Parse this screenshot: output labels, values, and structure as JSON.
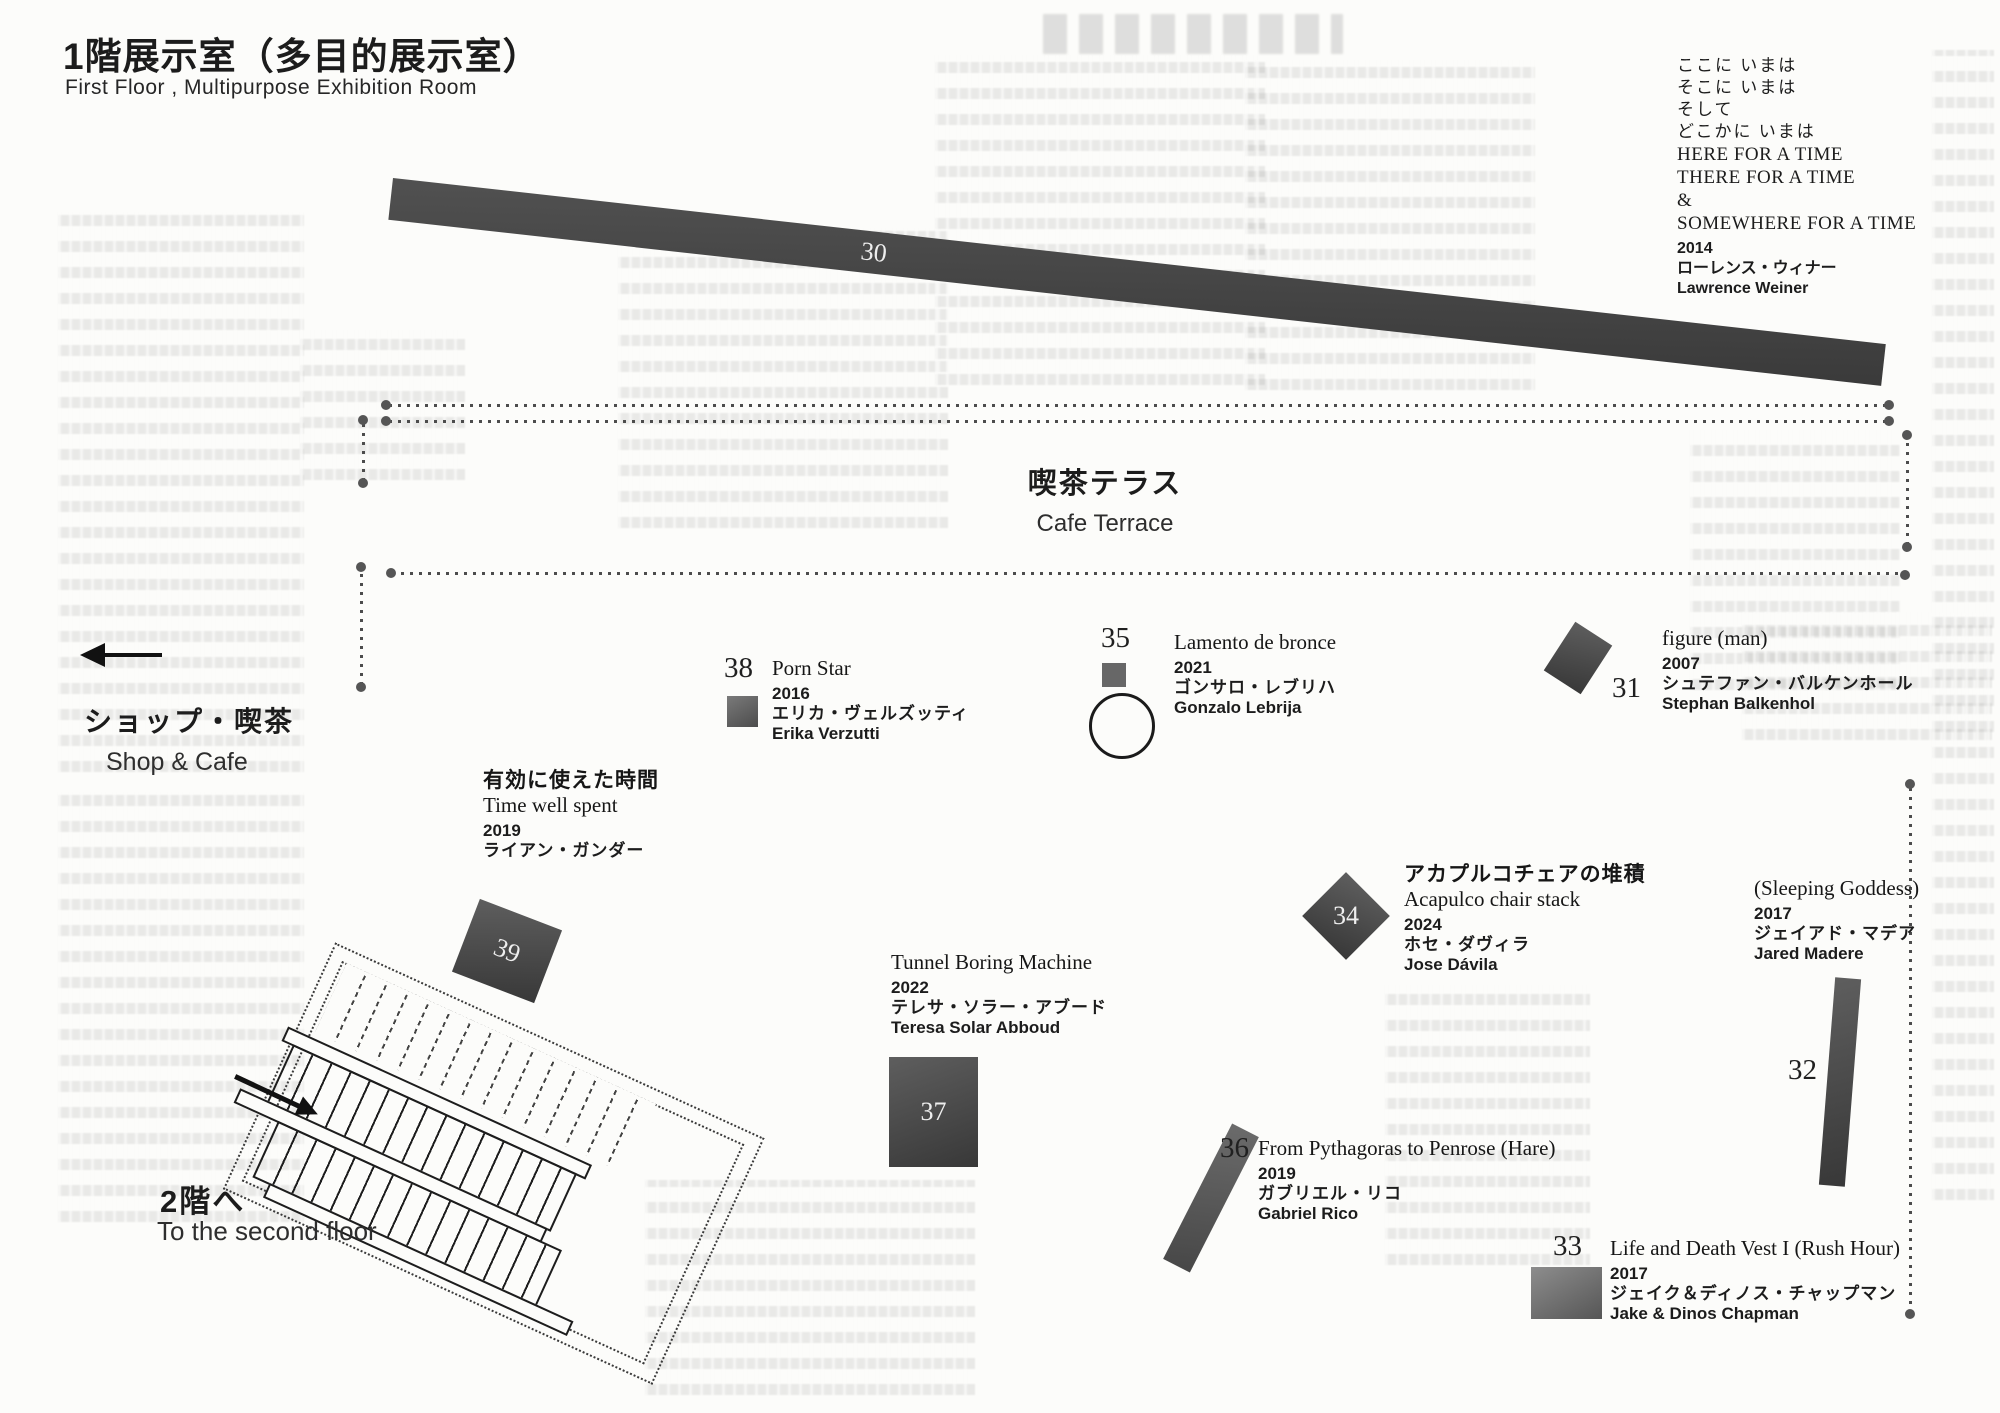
{
  "page": {
    "title_ja": "1階展示室（多目的展示室）",
    "title_en": "First Floor , Multipurpose Exhibition Room"
  },
  "areas": {
    "cafe_terrace": {
      "ja": "喫茶テラス",
      "en": "Cafe Terrace"
    },
    "shop_cafe": {
      "ja": "ショップ・喫茶",
      "en": "Shop & Cafe"
    },
    "stairs": {
      "ja": "2階へ",
      "en": "To the second floor"
    }
  },
  "artworks": {
    "a30": {
      "number": "30",
      "caption_lines_ja": [
        "ここに いまは",
        "そこに いまは",
        "そして",
        "どこかに いまは"
      ],
      "caption_lines_en": [
        "HERE FOR A TIME",
        "THERE FOR A TIME",
        "&",
        "SOMEWHERE FOR A TIME"
      ],
      "year": "2014",
      "artist_ja": "ローレンス・ウィナー",
      "artist_en": "Lawrence Weiner"
    },
    "a31": {
      "number": "31",
      "title": "figure (man)",
      "year": "2007",
      "artist_ja": "シュテファン・バルケンホール",
      "artist_en": "Stephan Balkenhol"
    },
    "a32": {
      "number": "32",
      "title": "(Sleeping Goddess)",
      "year": "2017",
      "artist_ja": "ジェイアド・マデア",
      "artist_en": "Jared Madere"
    },
    "a33": {
      "number": "33",
      "title": "Life and Death Vest I (Rush Hour)",
      "year": "2017",
      "artist_ja": "ジェイク＆ディノス・チャップマン",
      "artist_en": "Jake & Dinos Chapman"
    },
    "a34": {
      "number": "34",
      "title_ja": "アカプルコチェアの堆積",
      "title": "Acapulco chair stack",
      "year": "2024",
      "artist_ja": "ホセ・ダヴィラ",
      "artist_en": "Jose Dávila"
    },
    "a35": {
      "number": "35",
      "title": "Lamento de bronce",
      "year": "2021",
      "artist_ja": "ゴンサロ・レブリハ",
      "artist_en": "Gonzalo Lebrija"
    },
    "a36": {
      "number": "36",
      "title": "From Pythagoras to Penrose (Hare)",
      "year": "2019",
      "artist_ja": "ガブリエル・リコ",
      "artist_en": "Gabriel Rico"
    },
    "a37": {
      "number": "37",
      "title": "Tunnel Boring Machine",
      "year": "2022",
      "artist_ja": "テレサ・ソラー・アブード",
      "artist_en": "Teresa Solar Abboud"
    },
    "a38": {
      "number": "38",
      "title": "Porn Star",
      "year": "2016",
      "artist_ja": "エリカ・ヴェルズッティ",
      "artist_en": "Erika Verzutti"
    },
    "a39": {
      "number": "39",
      "title_ja": "有効に使えた時間",
      "title": "Time well spent",
      "year": "2019",
      "artist_ja": "ライアン・ガンダー"
    }
  },
  "colors": {
    "paper": "#fcfcfa",
    "ink": "#1c1c1c",
    "footprint_gray": "#474747"
  }
}
